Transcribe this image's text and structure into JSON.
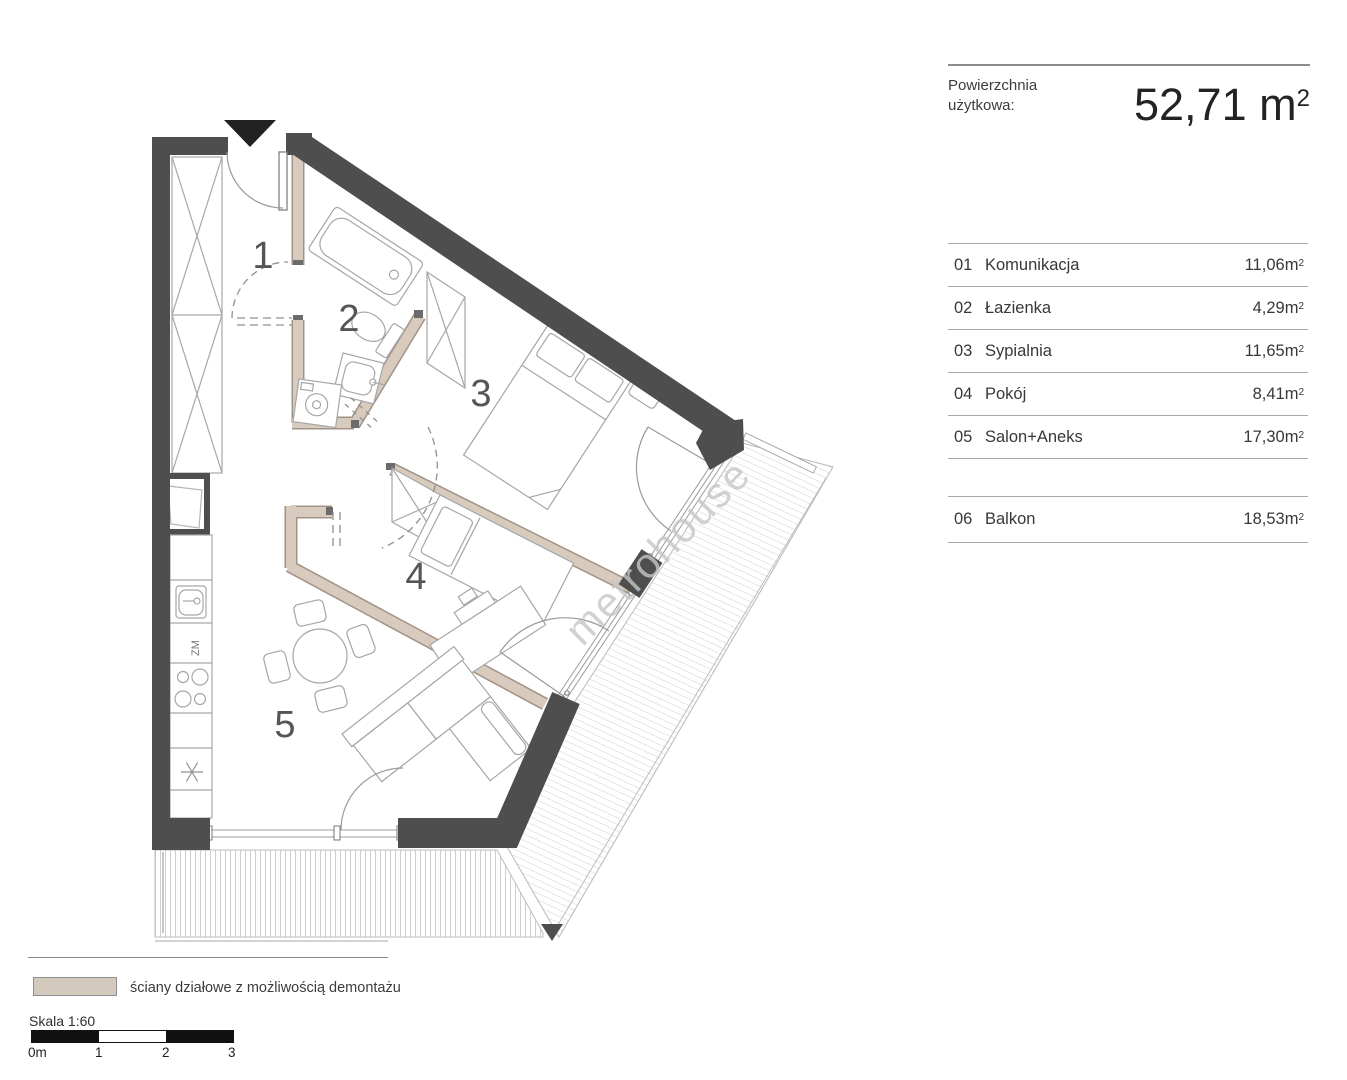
{
  "title_block": {
    "label_line1": "Powierzchnia",
    "label_line2": "użytkowa:",
    "value": "52,71"
  },
  "units": {
    "base": "m",
    "sup": "2"
  },
  "rooms": [
    {
      "no": "01",
      "name": "Komunikacja",
      "area": "11,06"
    },
    {
      "no": "02",
      "name": "Łazienka",
      "area": "4,29"
    },
    {
      "no": "03",
      "name": "Sypialnia",
      "area": "11,65"
    },
    {
      "no": "04",
      "name": "Pokój",
      "area": "8,41"
    },
    {
      "no": "05",
      "name": "Salon+Aneks",
      "area": "17,30"
    }
  ],
  "extra_rooms": [
    {
      "no": "06",
      "name": "Balkon",
      "area": "18,53"
    }
  ],
  "plan": {
    "room_labels": [
      "1",
      "2",
      "3",
      "4",
      "5"
    ],
    "kitchen_label": "ZM",
    "watermark": "metrohouse"
  },
  "legend": {
    "label": "ściany działowe z możliwością demontażu",
    "swatch_style": "background:#d4c9bd;border:1px solid #8f8f8f"
  },
  "scale": {
    "label": "Skala 1:60",
    "ticks": [
      "0m",
      "1",
      "2",
      "3"
    ]
  },
  "colors": {
    "wall": "#4e4e4e",
    "partition": "#d8cabc",
    "hatch": "#cfcfcf"
  }
}
